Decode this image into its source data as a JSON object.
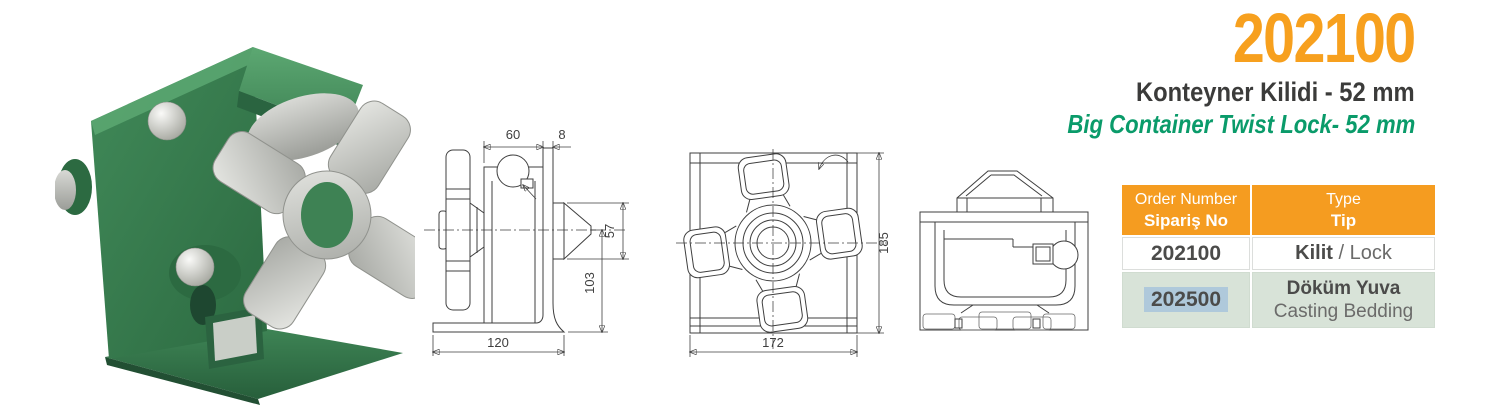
{
  "product": {
    "code": "202100",
    "name_tr": "Konteyner Kilidi - 52 mm",
    "name_en": "Big Container Twist Lock- 52 mm"
  },
  "colors": {
    "accent_orange": "#F7A01E",
    "accent_green": "#0A9B6A",
    "dark_text": "#3B3B3A",
    "table_header_bg": "#F59C20",
    "table_alt_row_bg": "#D8E3D8",
    "highlight_blue": "#AFC9DB",
    "product_green": "#3E8254",
    "drawing_line": "#3F3F3F"
  },
  "drawings": {
    "side_view": {
      "dim_top_width": "60",
      "dim_plate_thickness": "8",
      "dim_cone_height": "57",
      "dim_lower_height": "103",
      "dim_base_width": "120"
    },
    "front_view": {
      "dim_height": "185",
      "dim_width": "172"
    }
  },
  "table": {
    "header": {
      "order_number_en": "Order Number",
      "order_number_tr": "Sipariş No",
      "type_en": "Type",
      "type_tr": "Tip"
    },
    "rows": [
      {
        "order_number": "202100",
        "type_bold": "Kilit",
        "type_regular": " / Lock"
      },
      {
        "order_number": "202500",
        "type_bold": "Döküm Yuva",
        "type_regular": "Casting Bedding"
      }
    ]
  }
}
